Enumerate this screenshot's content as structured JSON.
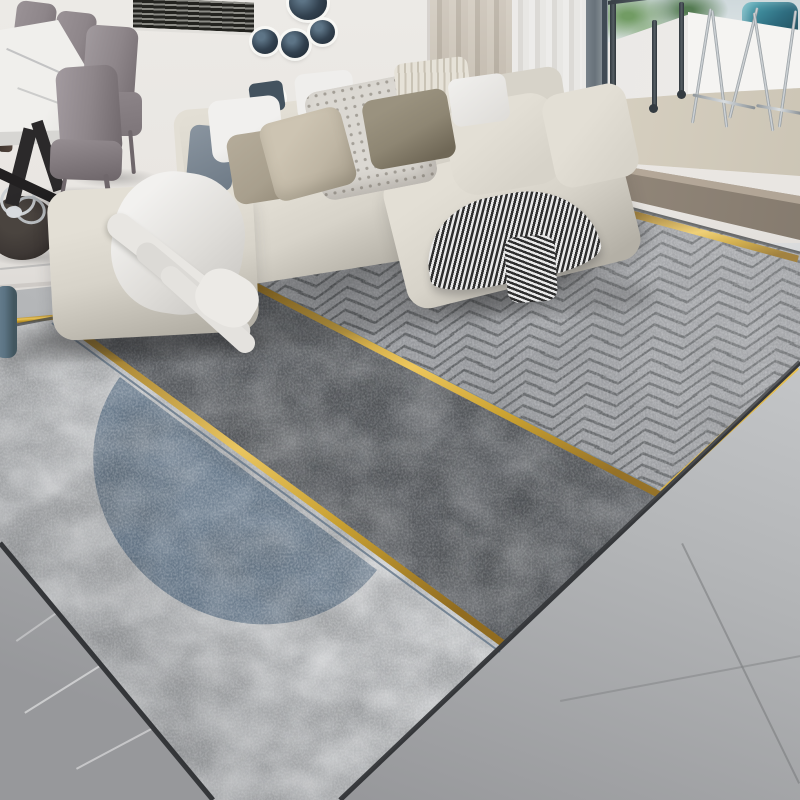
{
  "scene": {
    "type": "interior-photo",
    "subject": "modern living room with geometric area rug, L-shaped cream sectional sofa, dining set and balcony",
    "rug": {
      "style": "geometric",
      "zones": [
        {
          "name": "light-mottled-field",
          "color_key": "rug_light"
        },
        {
          "name": "charcoal-mottled-band",
          "color_key": "rug_charcoal"
        },
        {
          "name": "chevron-textured-field",
          "color_key": "rug_chevron"
        },
        {
          "name": "blue-half-circle",
          "color_key": "rug_blue"
        }
      ],
      "accents": [
        "gold-diagonal-line-1",
        "gold-diagonal-line-2",
        "gold-edge-trim",
        "blue-pinstripes"
      ]
    },
    "furniture": [
      "cream-sectional-sofa",
      "ottoman",
      "white-throw-blanket",
      "striped-throw",
      "marble-dining-table",
      "taupe-leather-chairs",
      "round-side-table",
      "blue-ceramic-stool"
    ],
    "decor": [
      "navy-wall-plates",
      "window-blinds",
      "beige-curtain",
      "sheer-curtain",
      "balcony-bar-stools",
      "balcony-railing",
      "green-foliage-outside",
      "teal-glass-vase"
    ]
  },
  "palette": {
    "wall": "#e9e6e2",
    "wall_dark": "#d7d4d0",
    "floor_bright": "#e3e5e6",
    "floor_base": "#b3b5b7",
    "floor_dark": "#97989b",
    "step": "#9b8f81",
    "step_dark": "#80766a",
    "wood": "#d9d2c3",
    "parapet": "#f5f4f2",
    "parapet_shadow": "#e3e1de",
    "glass": "#cfd9dc",
    "foliage": "#61914f",
    "teal_vase": "#2f6d80",
    "frame": "#68727a",
    "frame_dark": "#414b55",
    "blind_slat": "#23231f",
    "curtain_beige": "#c6bdb0",
    "curtain_sheer": "#edecea",
    "plate_navy": "#32414f",
    "plate_navy_light": "#5d7486",
    "marble": "#f0efec",
    "marble_edge": "#d7d6d3",
    "table_leg": "#2b292a",
    "chair_taupe": "#8e868a",
    "chair_taupe_dark": "#6f676b",
    "chair_brown": "#52443c",
    "side_table": "#3e3835",
    "vase_blue": "#5b7383",
    "sofa": "#d7d3c9",
    "sofa_light": "#e3dfd5",
    "sofa_shadow": "#b4b0a6",
    "pillow_white": "#f1f0ee",
    "pillow_slate": "#8a95a0",
    "pillow_navy": "#44535f",
    "pillow_taupe": "#a89f8d",
    "pillow_beige": "#bfb6a4",
    "pillow_dot": "#dbd8d2",
    "pillow_stripe": "#e6e2d8",
    "pillow_khaki": "#8e8673",
    "blanket": "#efeeec",
    "throw_dark": "#2e2e2e",
    "throw_light": "#e9e9e9",
    "rug_light": "#b6b8ba",
    "rug_charcoal": "#55585c",
    "rug_blue": "#677a8d",
    "rug_chevron": "#989a9e",
    "rug_edge": "#37393c",
    "gold": "#d3a12f",
    "gold_light": "#edc75c",
    "gold_dark": "#8f691a"
  }
}
